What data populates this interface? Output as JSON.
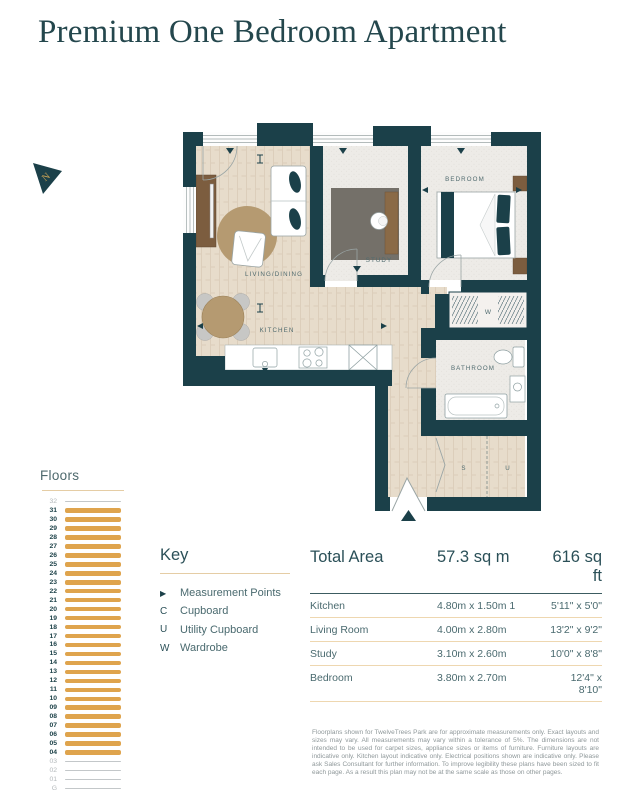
{
  "page": {
    "title": "Premium One Bedroom Apartment"
  },
  "colors": {
    "wall": "#1b4049",
    "accent_orange": "#dfa44d",
    "heading_teal": "#2b5058",
    "body_teal": "#4a6a6f",
    "tan_rule": "#e5cda5"
  },
  "floorplan": {
    "labels": {
      "living": "LIVING/DINING",
      "kitchen": "KITCHEN",
      "study": "STUDY",
      "bedroom": "BEDROOM",
      "bathroom": "BATHROOM",
      "storage": "S",
      "utility": "U",
      "wardrobe": "W"
    }
  },
  "floors": {
    "heading": "Floors",
    "items": [
      {
        "label": "32",
        "active": false
      },
      {
        "label": "31",
        "active": true
      },
      {
        "label": "30",
        "active": true
      },
      {
        "label": "29",
        "active": true
      },
      {
        "label": "28",
        "active": true
      },
      {
        "label": "27",
        "active": true
      },
      {
        "label": "26",
        "active": true
      },
      {
        "label": "25",
        "active": true
      },
      {
        "label": "24",
        "active": true
      },
      {
        "label": "23",
        "active": true
      },
      {
        "label": "22",
        "active": true
      },
      {
        "label": "21",
        "active": true
      },
      {
        "label": "20",
        "active": true
      },
      {
        "label": "19",
        "active": true
      },
      {
        "label": "18",
        "active": true
      },
      {
        "label": "17",
        "active": true
      },
      {
        "label": "16",
        "active": true
      },
      {
        "label": "15",
        "active": true
      },
      {
        "label": "14",
        "active": true
      },
      {
        "label": "13",
        "active": true
      },
      {
        "label": "12",
        "active": true
      },
      {
        "label": "11",
        "active": true
      },
      {
        "label": "10",
        "active": true
      },
      {
        "label": "09",
        "active": true
      },
      {
        "label": "08",
        "active": true
      },
      {
        "label": "07",
        "active": true
      },
      {
        "label": "06",
        "active": true
      },
      {
        "label": "05",
        "active": true
      },
      {
        "label": "04",
        "active": true
      },
      {
        "label": "03",
        "active": false
      },
      {
        "label": "02",
        "active": false
      },
      {
        "label": "01",
        "active": false
      },
      {
        "label": "G",
        "active": false
      }
    ]
  },
  "key": {
    "heading": "Key",
    "items": [
      {
        "symbol": "▶",
        "label": "Measurement Points"
      },
      {
        "symbol": "C",
        "label": "Cupboard"
      },
      {
        "symbol": "U",
        "label": "Utility Cupboard"
      },
      {
        "symbol": "W",
        "label": "Wardrobe"
      }
    ]
  },
  "area_table": {
    "header": {
      "name": "Total Area",
      "metric": "57.3 sq m",
      "imperial": "616 sq ft"
    },
    "rows": [
      {
        "name": "Kitchen",
        "metric": "4.80m x 1.50m 1",
        "imperial": "5'11\" x 5'0\""
      },
      {
        "name": "Living Room",
        "metric": "4.00m x 2.80m",
        "imperial": "13'2\" x 9'2\""
      },
      {
        "name": "Study",
        "metric": "3.10m x 2.60m",
        "imperial": "10'0\" x 8'8\""
      },
      {
        "name": "Bedroom",
        "metric": "3.80m x 2.70m",
        "imperial": "12'4\" x 8'10\""
      }
    ]
  },
  "disclaimer": "Floorplans shown for TwelveTrees Park are for approximate measurements only. Exact layouts and sizes may vary. All measurements may vary within a tolerance of 5%. The dimensions are not intended to be used for carpet sizes, appliance sizes or items of furniture. Furniture layouts are indicative only. Kitchen layout indicative only. Electrical positions shown are indicative only. Please ask Sales Consultant for further information. To improve legibility these plans have been sized to fit each page. As a result this plan may not be at the same scale as those on other pages."
}
